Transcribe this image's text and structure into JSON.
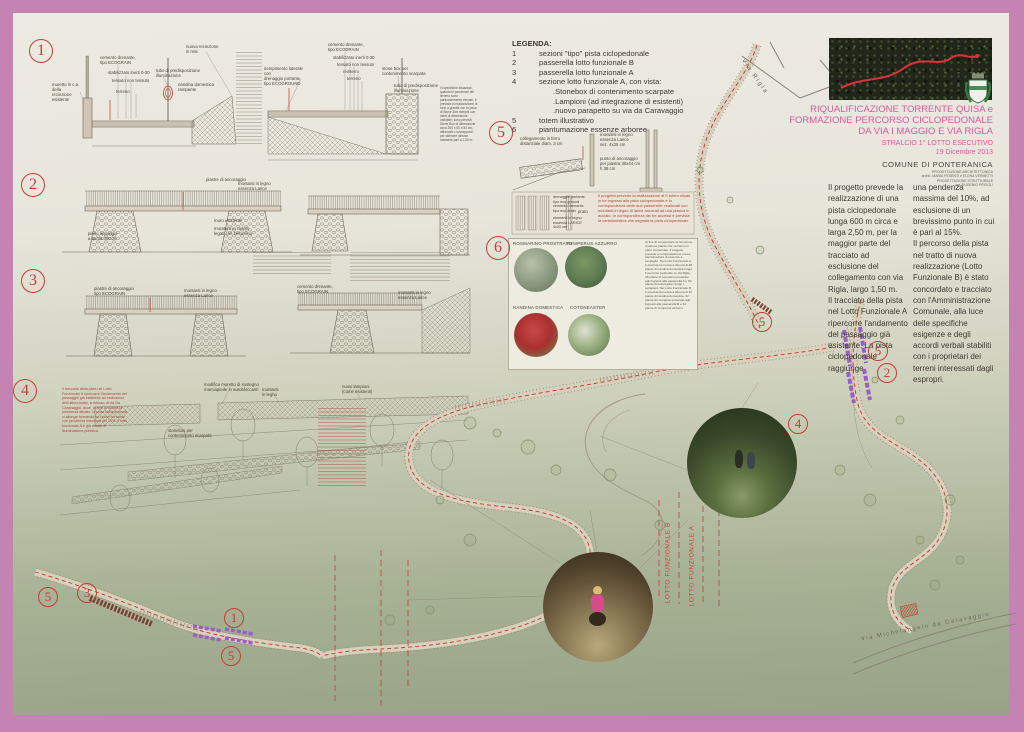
{
  "colors": {
    "frame": "#c583b4",
    "accent_red": "#c43f35",
    "magenta": "#d65a9e",
    "purple": "#9a5fc4",
    "band": "#d8cfbc"
  },
  "legend": {
    "title": "LEGENDA:",
    "items": [
      {
        "num": "1",
        "text": "sezioni  \"tipo\" pista ciclopedonale"
      },
      {
        "num": "2",
        "text": "passerella lotto funzionale B"
      },
      {
        "num": "3",
        "text": "passerella lotto funzionale A"
      },
      {
        "num": "4",
        "text": "sezione lotto funzionale A, con vista:"
      },
      {
        "num": "",
        "text": ".Stonebox di contenimento scarpate"
      },
      {
        "num": "",
        "text": ".Lampioni (ad integrazione di esistenti)"
      },
      {
        "num": "",
        "text": ".nuovo parapetto su via da Caravaggio"
      },
      {
        "num": "5",
        "text": "totem illustrativo"
      },
      {
        "num": "6",
        "text": "piantumazione essenze arboree"
      }
    ]
  },
  "title_block": {
    "line1": "RIQUALIFICAZIONE TORRENTE QUISA e",
    "line2": "FORMAZIONE PERCORSO CICLOPEDONALE",
    "line3": "DA VIA I MAGGIO E VIA RIGLA",
    "subtitle": "STRALCIO 1° LOTTO ESECUTIVO",
    "date": "19 Dicembre 2013",
    "municipality": "COMUNE DI PONTERANICA",
    "credits": "PROGETTAZIONE ARCHITETTONICA\narchh. MARIA PESENTI e ELENA VERMETTI\nPROGETTAZIONE STRUTTURALE\ning. EUGENIO FRIGOLI"
  },
  "intro": {
    "col1": "Il progetto prevede la realizzazione di una pista ciclopedonale lunga 600 m circa e larga 2,50 m, per la maggior parte del tracciato ad esclusione del collegamento con via Rigla, largo 1,50 m.\nIl tracciato della pista nel Lotto Funzionale A ripercorre l'andamento del passaggio già esistente. La pista ciclopedonale raggiunge",
    "col2": "una pendenza massima del 10%, ad esclusione di un brevissimo punto in cui è pari al 15%.\nIl percorso della pista nel tratto di nuova realizzazione (Lotto Funzionale B) è stato concordato e tracciato con l'Amministrazione Comunale, alla luce delle specifiche esigenze e degli accordi verbali stabiliti con i proprietari dei terreni interessati dagli espropri."
  },
  "sections": {
    "n1": "1",
    "n2": "2",
    "n3": "3",
    "n4": "4",
    "n5": "5",
    "n6": "6",
    "s1_left": [
      "nuova recinzione\nin rete",
      "cemento drenante,\ntipo ECOGRAIN",
      "stabilizzato inerti 0-30",
      "tessuto non tessuto",
      "terreno",
      "muretto in c.a. della\nrecinzione esistente",
      "tubo di predisposizione\nilluminazione",
      "nandina domestica\nrampante"
    ],
    "s1_right": [
      "riempimento laterale con\ndrenaggio portante,\ntipo ECOGROUND",
      "cemento drenante,\ntipo ECODRAIN",
      "stabilizzato inerti 0-30",
      "tessuto non tessuto",
      "reinterro",
      "terreno",
      "stone box per\ncontenimento scarpata",
      "tubo di predisposizione\nilluminazione"
    ],
    "s1_note": "In specifiche situazioni, quando le pendenze del terreno sono particolarmente elevate, è prevista la realizzazione di muri a gravità con la posa di Stone Box riempiti con inerti di dimensione variabile; sono previsti Stone Box di dimensione circa 200 x 50 h 50 cm, affiancati o sovrapposti per ottenere altezze massime pari a 1,50 m.",
    "s2": [
      "piastre di ancoraggio",
      "montanti in legno\nessenza Larice",
      "piano appoggio\na quota 300.26",
      "muro esistente",
      "muratura in ciclopi\nlegati con betoncino"
    ],
    "s3": [
      "piastre di ancoraggio\ntipo ECOGRAIN",
      "montanti in legno\nessenza Larice",
      "cemento drenante,\ntipo ECOGRAIN",
      "montanti in legno\nessenza Larice"
    ],
    "s4_labels": [
      "montanti\nin legno",
      "modifica muretto di sostegno\nmarciapiede in autobloccanti",
      "nuovi lampioni\n(come esistenti)",
      "stonebox per\ncontenimento scarpata"
    ],
    "s4_note": "Il tracciato della pista nel Lotto Funzionale A ripercorre l'andamento del passaggio già esistente ad esclusione dell'ultimo tratto, a ridosso di via Da Caravaggio, dove, al fine di ridurre la pendenza attuale, la pista ciclopedonale si allunga formando un nuovo tornante con pendenza massima del 10%. Il lotto funzionale A è già dotato di illuminazione pubblica.",
    "s5_labels": [
      "collegamento in ferro\ndistanziale diam. 3 cm",
      "montanti in legno\nessenza Larice\nsez. 4x25 cm",
      "punto di ancoraggio\nper piastra 30x44 cm\nh 38 cm",
      "drenaggio portante\ntipo eco ground\ncemento drenante\ntipo eco drain",
      "elementi in legno\nessenza LARICE\n4x20 cm",
      "prato"
    ],
    "s5_note": "Il progetto prevede la realizzazione di 5 totem situati in tre ingressi alla pista ciclopedonale e in corrispondenza delle due passerelle; realizzati con montanti in legno di larice ancorati ad una piastra in acciaio. In corrispondenza dei tre accessi è prevista la cartellonistica che segnala la pista ciclopedonale."
  },
  "plants": {
    "names": [
      "ROSMARINO PROSTRATO",
      "YUNIPERUS AZZURRO",
      "NANDINA DOMESTICA",
      "COTONEASTER"
    ],
    "note": "Al fine di compensare la rimozione di alcune piante che verranno in parte conservate, il progetto prevede a compensazione nuove piantumazioni di essenze a cespuglio. Nel Lotto Funzionale A, è prevista la messa a dimora di 28 piante di nandina domestica lungo il percorso pedonale su via Rigla, 38 piante di rosmarino prostrato agli ingressi alla passerella A e 90 piante di cotoneaster lungo i terrapieni. Nel Lotto Funzionale B, è prevista la messa a dimora di 32 piante di nandina domestica, 32 piante di rosmarino prostrato agli ingressi alla passerella B e 42 piante di Yuniperus azzurro."
  },
  "map": {
    "street_rigla": "Via  Rigla",
    "street_caravaggio": "Via Michelangelo da Caravaggio",
    "lot_b": "LOTTO FUNZIONALE B",
    "lot_a": "LOTTO FUNZIONALE A",
    "markers": [
      {
        "n": "5"
      },
      {
        "n": "5"
      },
      {
        "n": "2"
      },
      {
        "n": "4"
      },
      {
        "n": "5"
      },
      {
        "n": "3"
      },
      {
        "n": "1"
      },
      {
        "n": "5"
      }
    ]
  }
}
